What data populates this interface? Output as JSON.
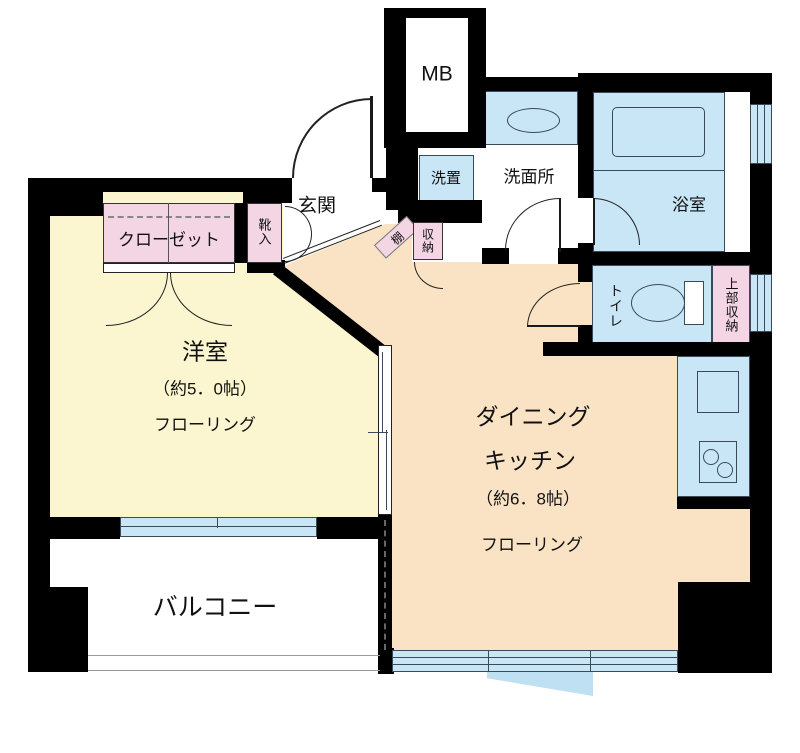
{
  "rooms": {
    "western_room": {
      "name": "洋室",
      "size": "（約5．0帖）",
      "flooring": "フローリング"
    },
    "dining_kitchen": {
      "name_line1": "ダイニング",
      "name_line2": "キッチン",
      "size": "（約6．8帖）",
      "flooring": "フローリング"
    },
    "balcony": {
      "name": "バルコニー"
    },
    "entrance": {
      "name": "玄関"
    },
    "washroom": {
      "name": "洗面所"
    },
    "bathroom": {
      "name": "浴室"
    },
    "toilet": {
      "name": "トイレ"
    }
  },
  "features": {
    "meter_box": "MB",
    "washer_space": "洗置",
    "closet": "クローゼット",
    "shoe_cabinet": "靴入",
    "shelf": "棚",
    "storage": "収納",
    "upper_storage": "上部収納"
  },
  "colors": {
    "wall": "#000000",
    "western_room_floor": "#FBF6D0",
    "dining_kitchen_floor": "#FAE3C5",
    "wet_area_blue": "#C9E6F6",
    "storage_pink": "#F4D5E3",
    "balcony_floor": "#FFFFFF"
  }
}
